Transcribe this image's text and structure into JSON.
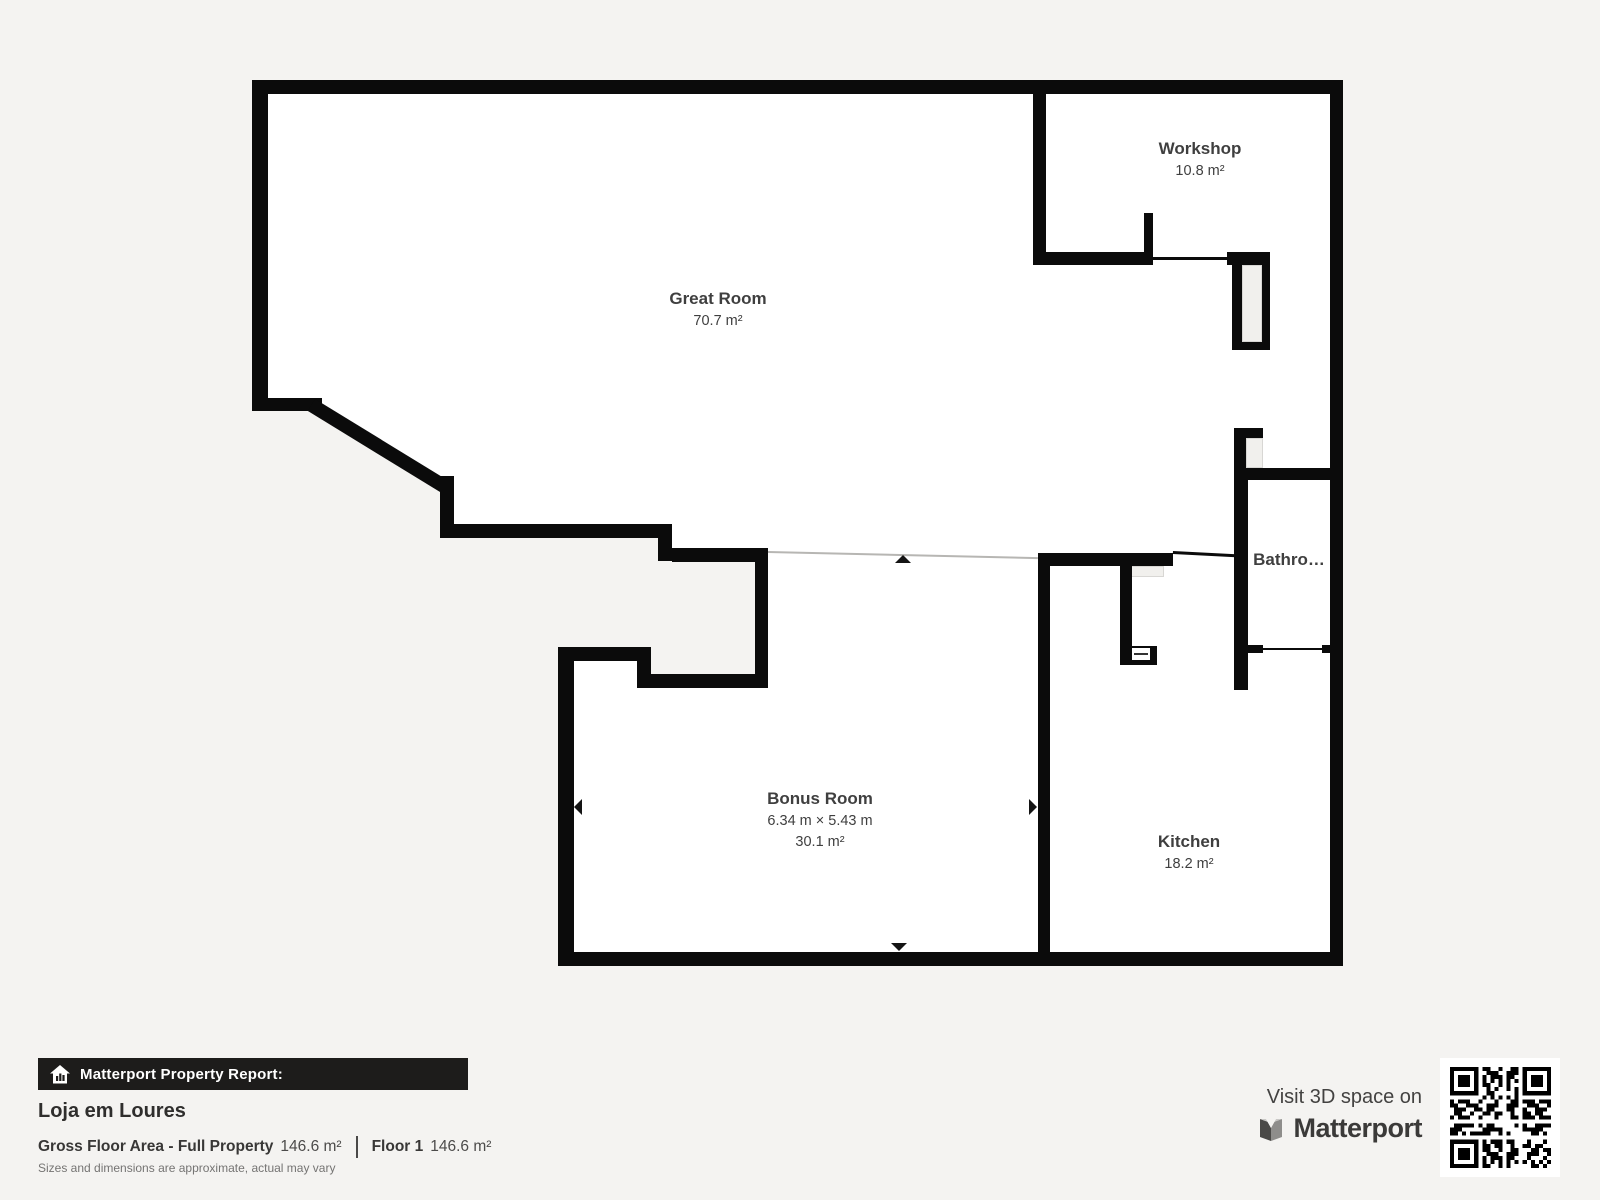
{
  "colors": {
    "page_background": "#f4f3f1",
    "wall": "#0b0b0b",
    "room_interior": "#ffffff",
    "label_text": "#3f3f3f",
    "report_bar": "#1d1c1b"
  },
  "rooms": {
    "great_room": {
      "name": "Great Room",
      "area": "70.7 m²"
    },
    "workshop": {
      "name": "Workshop",
      "area": "10.8 m²"
    },
    "bathroom": {
      "name": "Bathro…"
    },
    "bonus_room": {
      "name": "Bonus Room",
      "dimensions": "6.34 m × 5.43 m",
      "area": "30.1 m²"
    },
    "kitchen": {
      "name": "Kitchen",
      "area": "18.2 m²"
    }
  },
  "footer": {
    "report_label": "Matterport Property Report:",
    "property_name": "Loja em Loures",
    "gross_floor_area_label": "Gross Floor Area - Full Property",
    "gross_floor_area_value": "146.6 m²",
    "floor_label": "Floor 1",
    "floor_value": "146.6 m²",
    "disclaimer": "Sizes and dimensions are approximate, actual may vary",
    "visit_label": "Visit 3D space on",
    "brand": "Matterport"
  }
}
